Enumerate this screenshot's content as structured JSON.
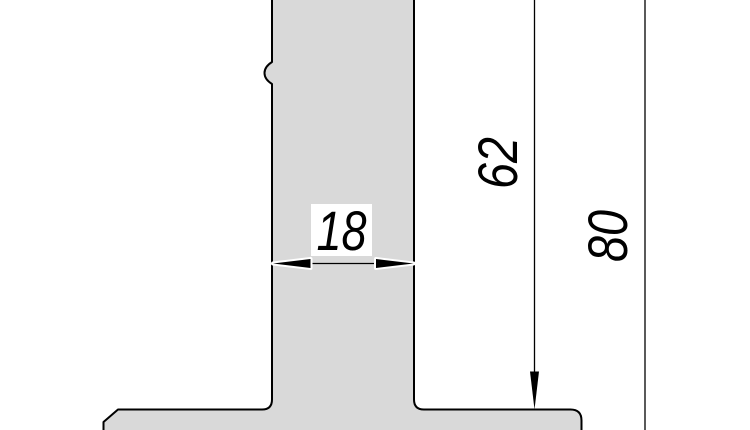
{
  "drawing": {
    "kind": "technical-section-drawing",
    "dimensions": {
      "stem_width": "18",
      "upper_height": "62",
      "total_height": "80"
    }
  },
  "colors": {
    "section_fill": "#d9d9d9",
    "outline": "#000000",
    "halo": "#ffffff",
    "background": "#ffffff"
  }
}
